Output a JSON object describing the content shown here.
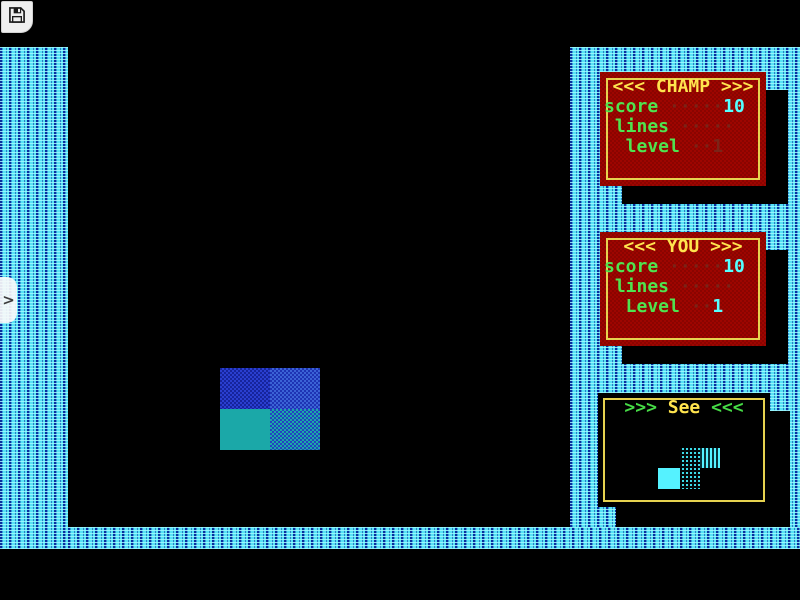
{
  "toolbar": {
    "save_icon": "floppy-disk"
  },
  "drawer_handle": {
    "chevron": ">"
  },
  "panels": {
    "champ": {
      "arrow_left": "<<<",
      "title": " CHAMP ",
      "arrow_right": ">>>",
      "rows": [
        {
          "label": "score",
          "dots": " ·····",
          "value": "10"
        },
        {
          "label": " lines",
          "dots": " ·····",
          "value": ""
        },
        {
          "label": "  level",
          "dots": " ··",
          "value": "1"
        }
      ]
    },
    "you": {
      "arrow_left": "<<<",
      "title": " YOU ",
      "arrow_right": ">>>",
      "rows": [
        {
          "label": "score",
          "dots": " ·····",
          "value": "10"
        },
        {
          "label": " lines",
          "dots": " ·····",
          "value": ""
        },
        {
          "label": "  Level",
          "dots": " ··",
          "value": "1"
        }
      ]
    },
    "see": {
      "arrow_left": ">>>",
      "title": " See ",
      "arrow_right": "<<<"
    }
  },
  "colors": {
    "wall_cyan": "#56E2F4",
    "panel_red": "#9E0500",
    "border_yellow": "#E6D24F",
    "title_yellow": "#FFE44E",
    "label_green": "#4FE44F",
    "value_cyan": "#55FFFF",
    "dots_maroon": "#7A2418",
    "piece_blue": "#2a3fd0",
    "piece_teal": "#1BA8A8",
    "preview_cyan": "#55F2FF"
  },
  "pieces": {
    "board": [
      {
        "left": 220,
        "top": 368,
        "width": 50,
        "height": 41,
        "texture": "blue-dark"
      },
      {
        "left": 270,
        "top": 368,
        "width": 50,
        "height": 41,
        "texture": "blue-light"
      },
      {
        "left": 220,
        "top": 409,
        "width": 50,
        "height": 41,
        "texture": "teal-solid"
      },
      {
        "left": 270,
        "top": 409,
        "width": 50,
        "height": 41,
        "texture": "teal-blue"
      }
    ],
    "preview": [
      {
        "left": 82,
        "top": 55,
        "width": 20,
        "height": 20,
        "texture": "cyan-sparse"
      },
      {
        "left": 102,
        "top": 55,
        "width": 20,
        "height": 20,
        "texture": "cyan-dense"
      },
      {
        "left": 60,
        "top": 75,
        "width": 22,
        "height": 21,
        "texture": "cyan-solid"
      },
      {
        "left": 82,
        "top": 75,
        "width": 20,
        "height": 21,
        "texture": "cyan-sparse"
      }
    ]
  }
}
